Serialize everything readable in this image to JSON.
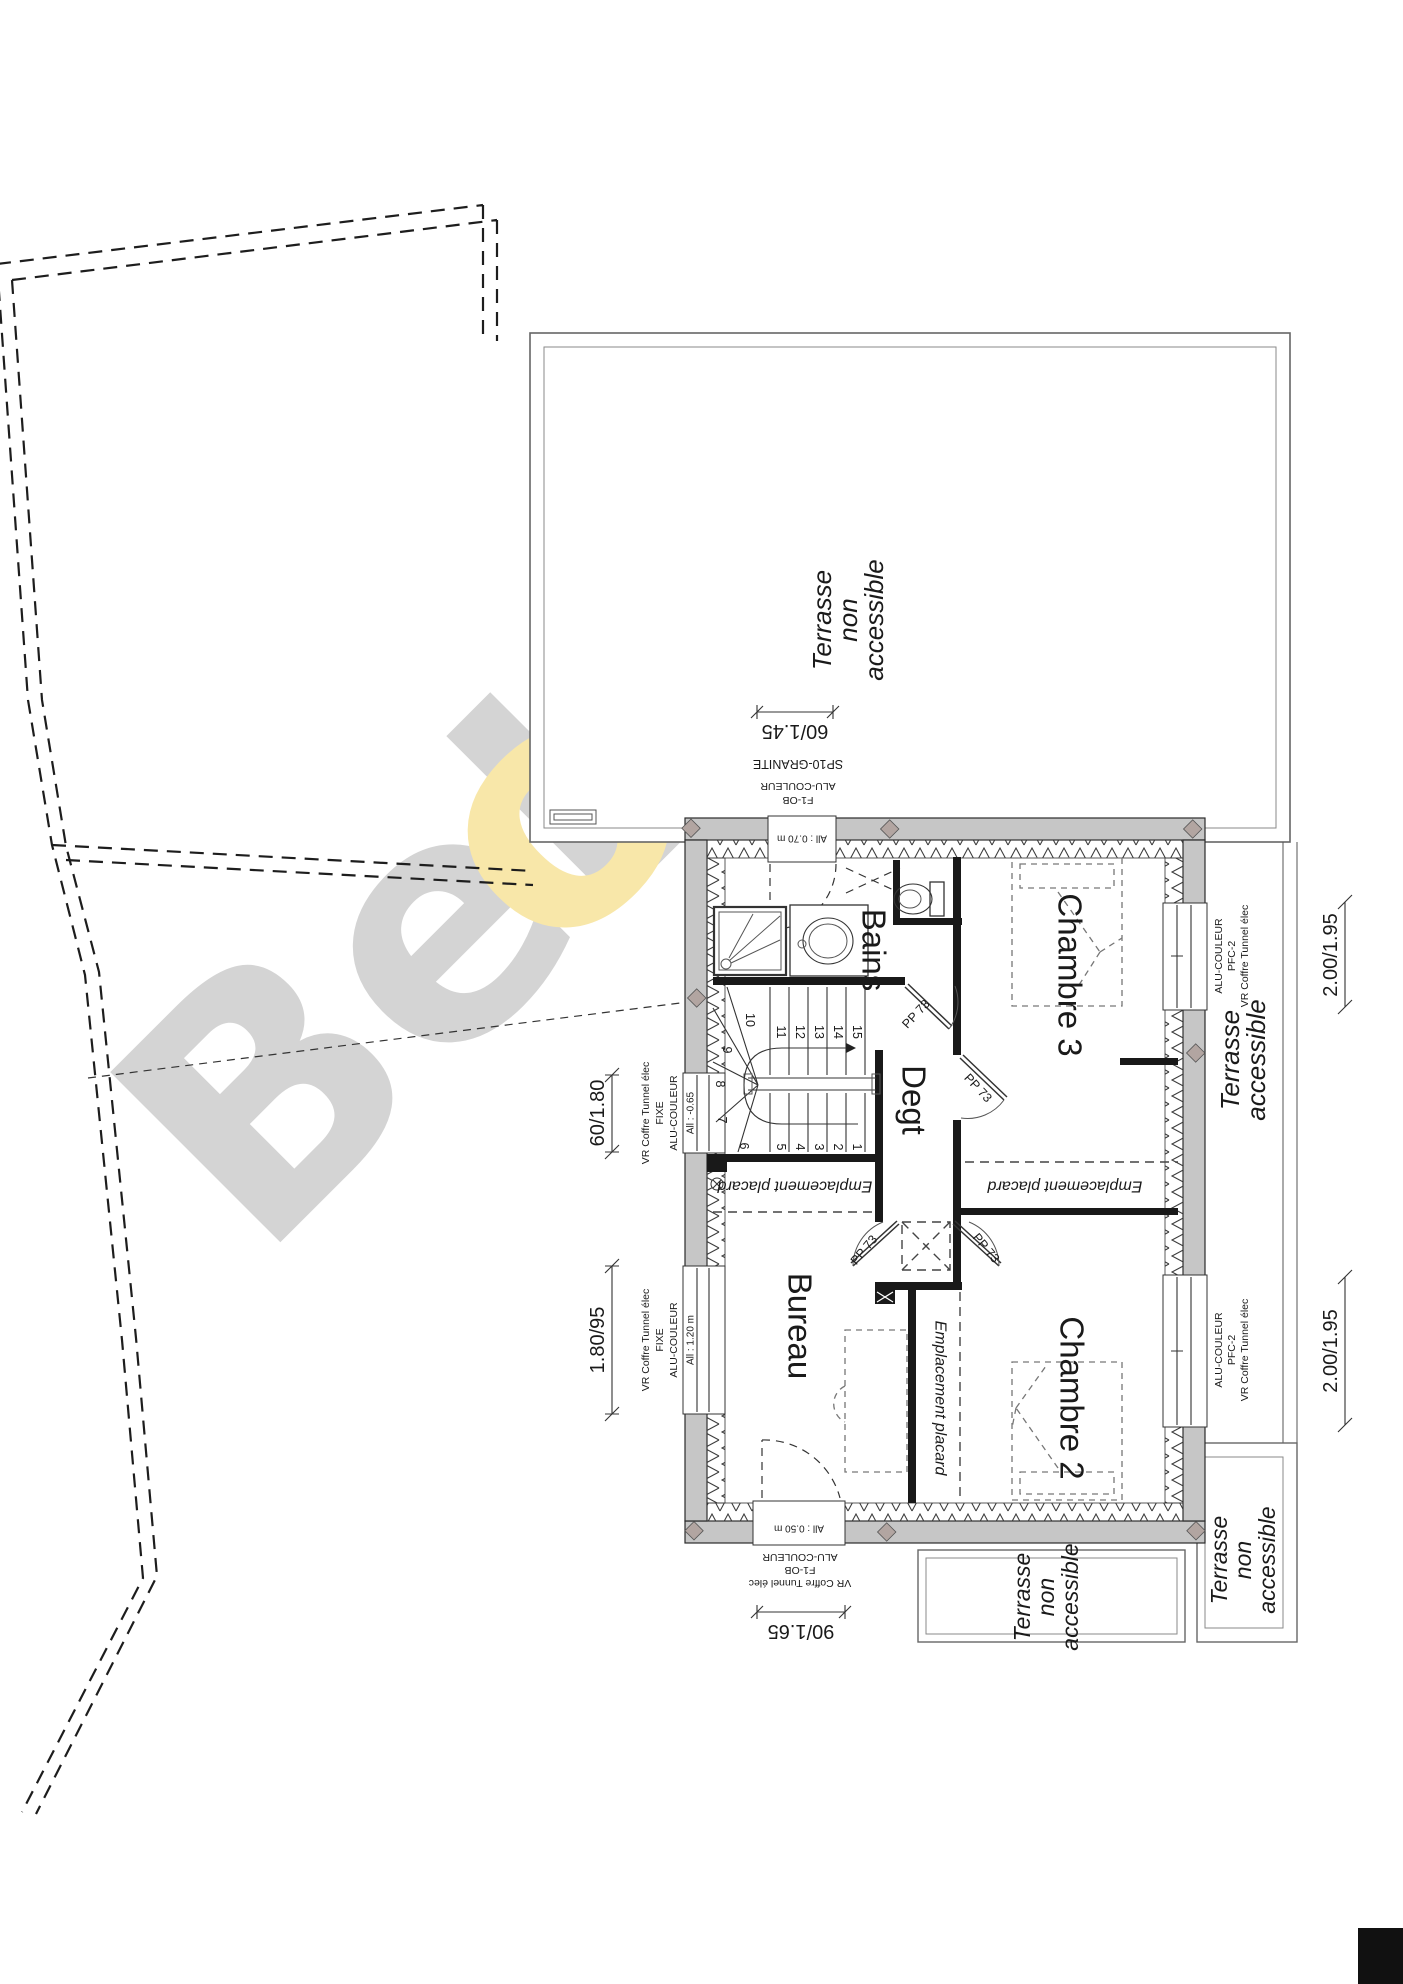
{
  "watermark": {
    "part1": "BeL",
    "part2": "o",
    "part3": "N"
  },
  "rooms": {
    "bains": "Bains",
    "degt": "Degt",
    "bureau": "Bureau",
    "chambre2": "Chambre 2",
    "chambre3": "Chambre 3"
  },
  "terraces": {
    "top": [
      "Terrasse",
      "non",
      "accessible"
    ],
    "east": [
      "Terrasse",
      "accessible"
    ],
    "bottom_left": [
      "Terrasse",
      "non",
      "accessible"
    ],
    "bottom_right": [
      "Terrasse",
      "non",
      "accessible"
    ]
  },
  "placard_label": "Emplacement placard",
  "door_label": "PP 73",
  "stairs": [
    "1",
    "2",
    "3",
    "4",
    "5",
    "6",
    "7",
    "8",
    "9",
    "10",
    "11",
    "12",
    "13",
    "14",
    "15"
  ],
  "dimensions": {
    "top": "60/1.45",
    "bottom": "90/1.65",
    "left_upper": "60/1.80",
    "left_lower": "1.80/95",
    "east_upper": "2.00/1.95",
    "east_lower": "2.00/1.95"
  },
  "allowances": {
    "top_door": "All : 0.70 m",
    "left_upper": "All : -0.65",
    "left_lower": "All : 1.20 m",
    "bottom_door": "All : 0.50 m"
  },
  "specs": {
    "granite": "SP10-GRANITE",
    "alu": "ALU-COULEUR",
    "f1ob": "F1-OB",
    "vr": "VR Coffre Tunnel élec",
    "fixe": "FIXE",
    "pfc2": "PFC-2"
  }
}
